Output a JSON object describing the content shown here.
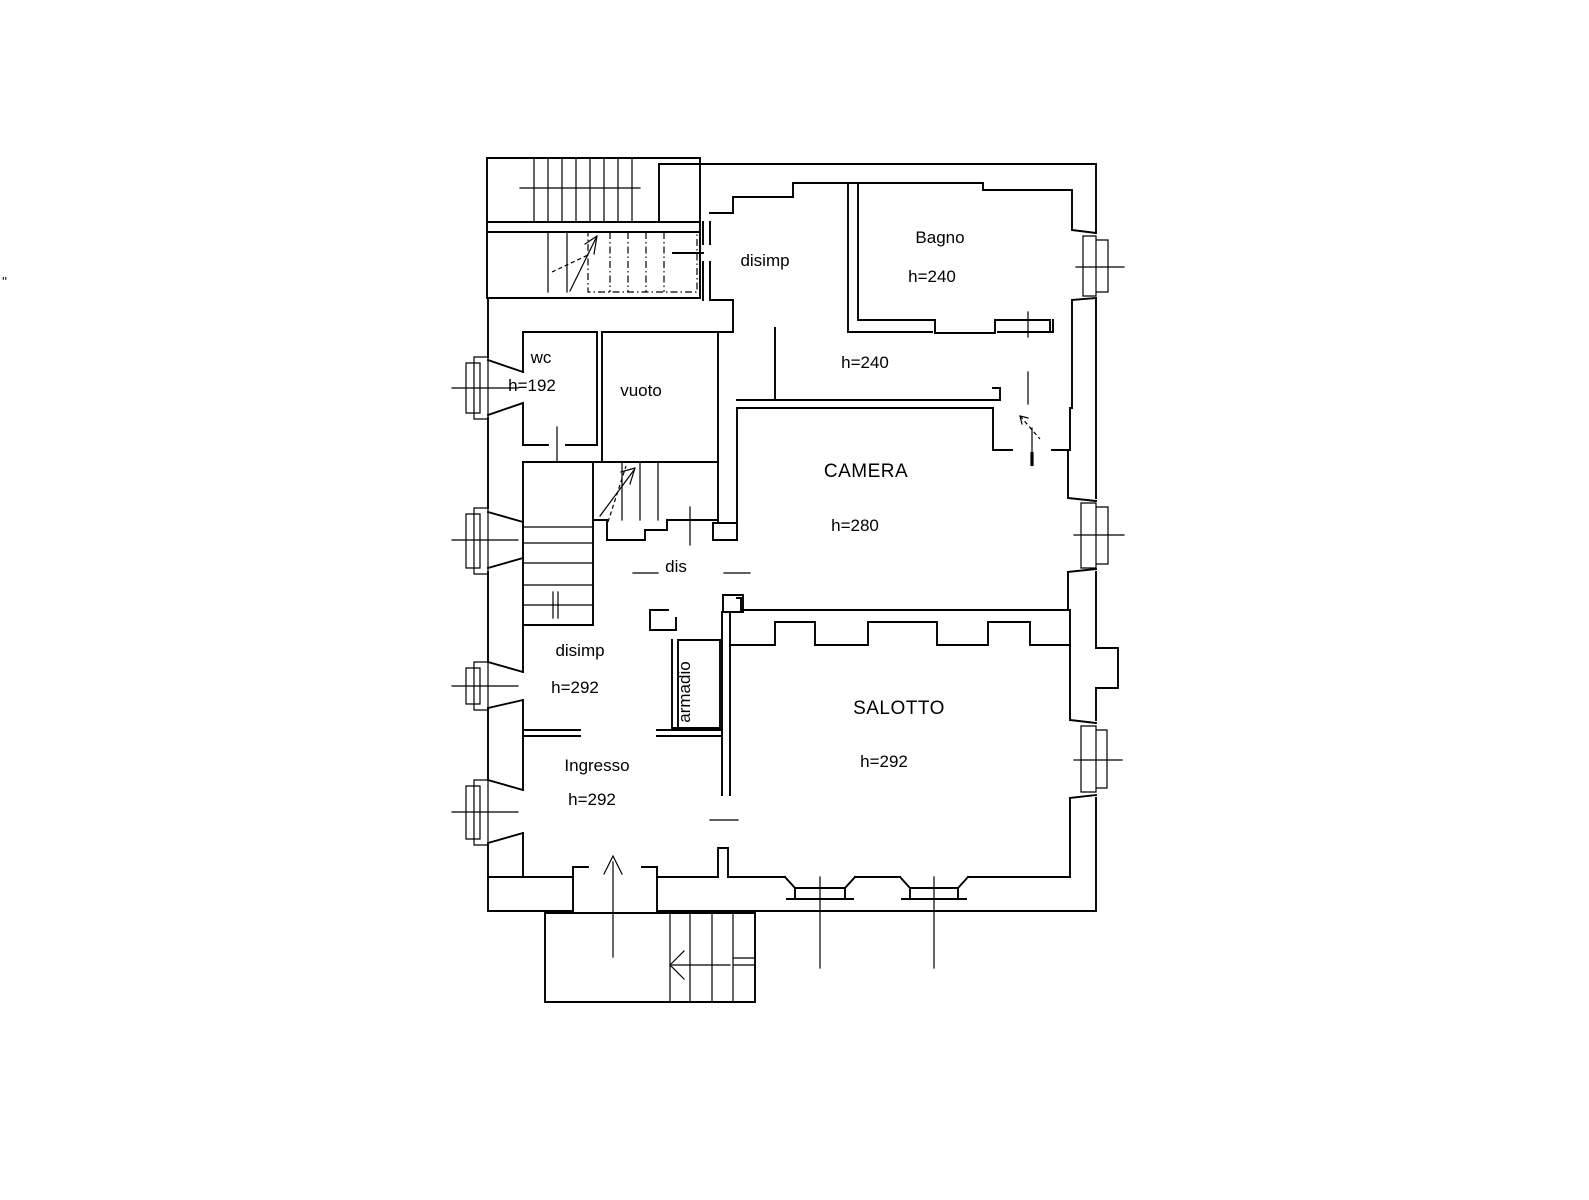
{
  "drawing": {
    "type": "floor-plan",
    "background_color": "#ffffff",
    "line_color": "#000000",
    "text_color": "#000000"
  },
  "rooms": [
    {
      "name": "disimp",
      "height_label": "h=240"
    },
    {
      "name": "Bagno",
      "height_label": "h=240"
    },
    {
      "name": "wc",
      "height_label": "h=192"
    },
    {
      "name": "vuoto",
      "height_label": ""
    },
    {
      "name": "CAMERA",
      "height_label": "h=280"
    },
    {
      "name": "dis",
      "height_label": ""
    },
    {
      "name": "disimp",
      "height_label": "h=292"
    },
    {
      "name": "armadio",
      "height_label": ""
    },
    {
      "name": "SALOTTO",
      "height_label": "h=292"
    },
    {
      "name": "Ingresso",
      "height_label": "h=292"
    }
  ],
  "annotations": {
    "left_edge_mark": "''"
  }
}
